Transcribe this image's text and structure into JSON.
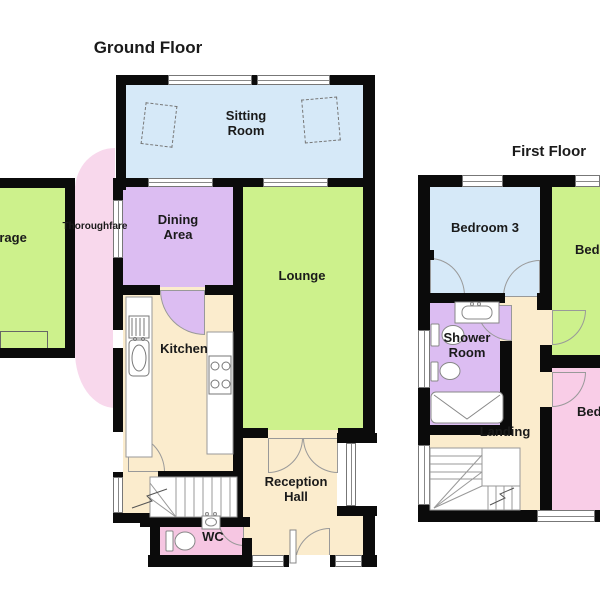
{
  "ground_floor": {
    "title": "Ground Floor",
    "rooms": {
      "sitting_room": "Sitting Room",
      "dining_area": "Dining Area",
      "lounge": "Lounge",
      "kitchen": "Kitchen",
      "thoroughfare": "Thoroughfare",
      "garage": "Garage",
      "reception_hall": "Reception Hall",
      "wc": "WC"
    }
  },
  "first_floor": {
    "title": "First Floor",
    "rooms": {
      "bedroom_3": "Bedroom 3",
      "bedroom_right_top": "Bedroom",
      "bedroom_right_bottom": "Bedroom",
      "shower_room": "Shower Room",
      "landing": "Landing"
    }
  },
  "colors": {
    "wall": "#0b0b0b",
    "sitting_room_blue": "#d6e9f8",
    "lounge_green": "#cdf18c",
    "dining_purple": "#dcbdf2",
    "thoroughfare_pink": "#f8d8ec",
    "wc_pink": "#f6c6e2",
    "bedroom_pink": "#f9cde7",
    "hall_cream": "#fbeccd"
  }
}
